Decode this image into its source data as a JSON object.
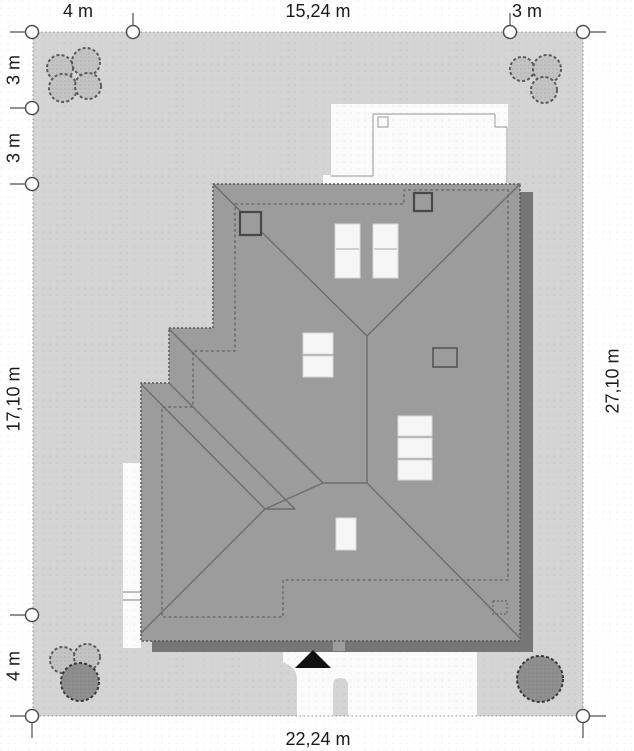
{
  "plan": {
    "dimensions": {
      "top": [
        "4 m",
        "15,24 m",
        "3 m"
      ],
      "left": [
        "3 m",
        "3 m",
        "17,10 m",
        "4 m"
      ],
      "right": [
        "27,10 m"
      ],
      "bottom": [
        "22,24 m"
      ]
    }
  },
  "colors": {
    "page_bg": "#ffffff",
    "plot_fill": "#d4d4d4",
    "roof_fill": "#9c9c9c",
    "roof_shadow": "#767676",
    "paving_white": "#fbfbfb",
    "terrace_white": "#fbfbfb",
    "bush_light": "#c3c3c3",
    "bush_dark": "#8e8e8e",
    "entrance_arrow": "#111111",
    "dimension_text": "#1a1a1a"
  },
  "icons": {
    "entrance_arrow": "black triangle pointing up at main entrance",
    "bush": "scalloped shrub symbol",
    "dimension_marker": "small circle with tick line"
  }
}
